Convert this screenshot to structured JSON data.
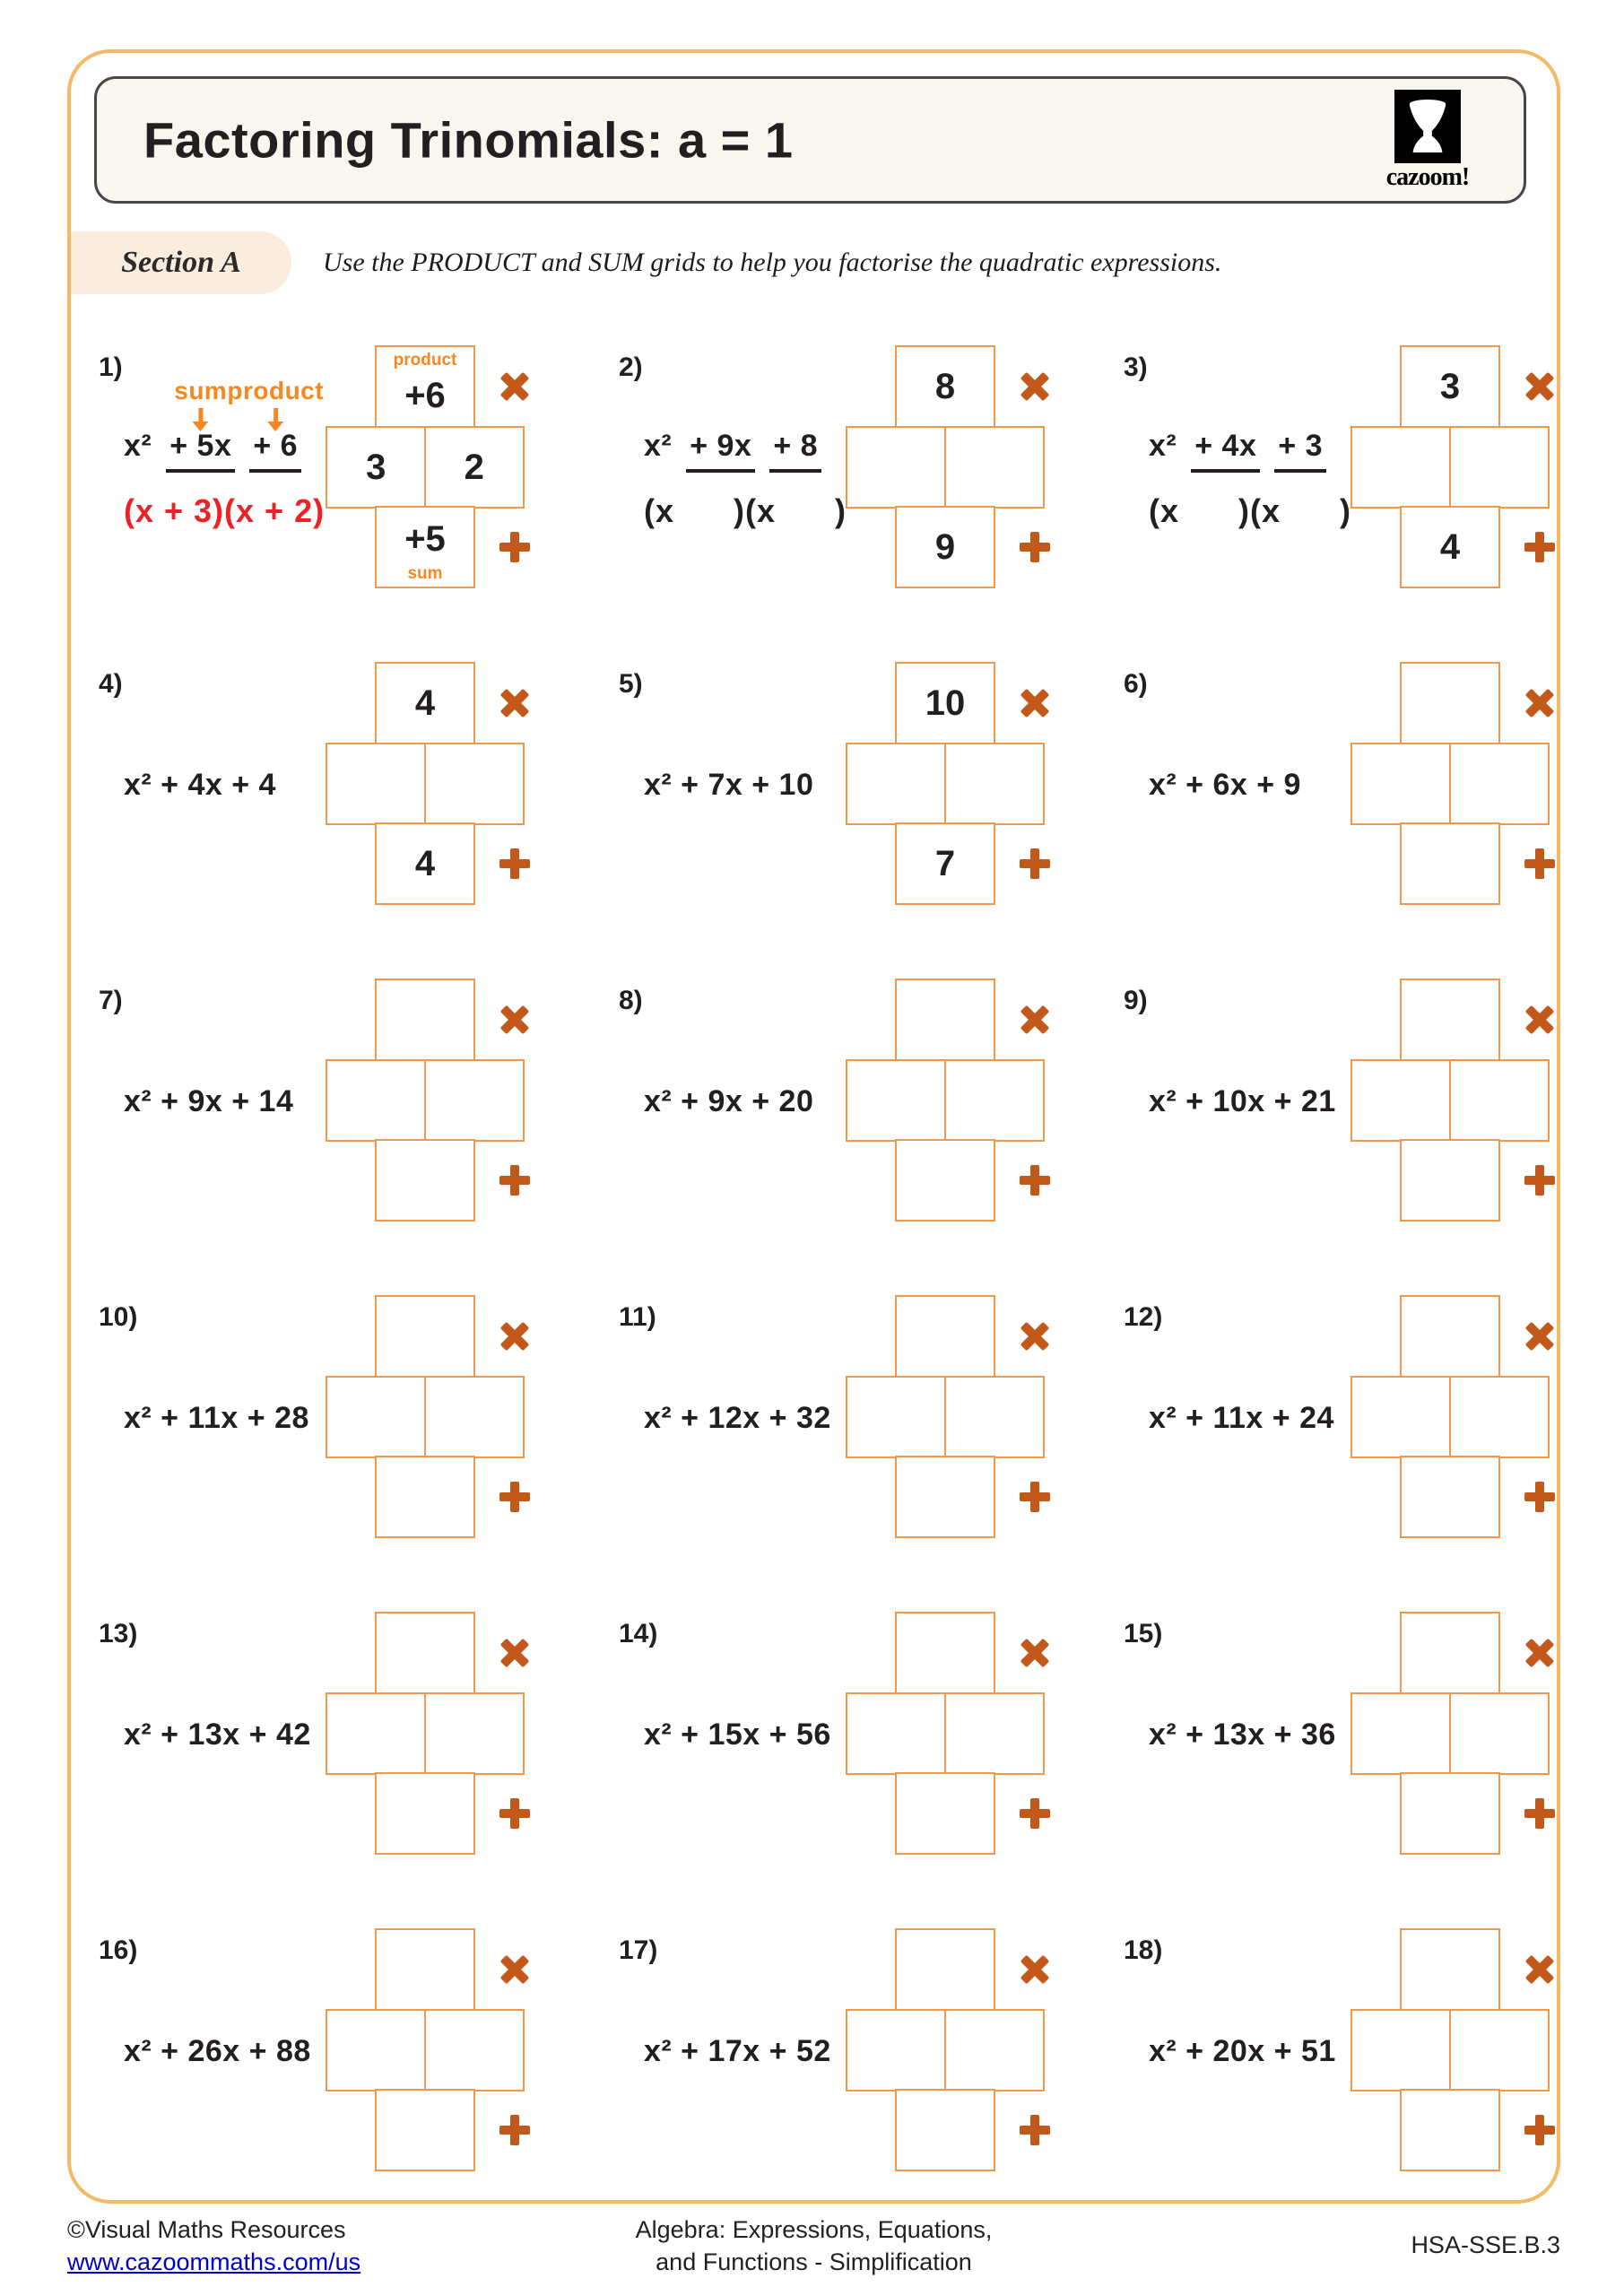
{
  "page": {
    "title": "Factoring Trinomials: a = 1",
    "logo_text": "cazoom!",
    "section_label": "Section A",
    "instruction": "Use the PRODUCT and SUM grids to help you factorise the quadratic expressions.",
    "colors": {
      "page_border": "#F4BA66",
      "grid_border": "#F0994A",
      "accent_orange": "#F6881F",
      "operator_orange": "#C2591B",
      "answer_red": "#EC2227",
      "ink": "#231F20",
      "header_bg": "#F8F6EF",
      "section_bg": "#FBEDDE",
      "link_blue": "#0000CC"
    }
  },
  "grid_labels": {
    "product": "product",
    "sum": "sum"
  },
  "problems": [
    {
      "number": "1)",
      "expr_parts": [
        "x²",
        "+ 5x",
        "+ 6"
      ],
      "annotations": [
        "sum",
        "product"
      ],
      "answer": "(x + 3)(x + 2)",
      "grid": {
        "product": "+6",
        "left": "3",
        "right": "2",
        "sum": "+5",
        "labels": true
      }
    },
    {
      "number": "2)",
      "expr_parts": [
        "x²",
        "+ 9x",
        "+ 8"
      ],
      "template": "(x      )(x      )",
      "grid": {
        "product": "8",
        "sum": "9"
      }
    },
    {
      "number": "3)",
      "expr_parts": [
        "x²",
        "+ 4x",
        "+ 3"
      ],
      "template": "(x      )(x      )",
      "grid": {
        "product": "3",
        "sum": "4"
      }
    },
    {
      "number": "4)",
      "expr": "x² + 4x + 4",
      "grid": {
        "product": "4",
        "sum": "4"
      }
    },
    {
      "number": "5)",
      "expr": "x² + 7x + 10",
      "grid": {
        "product": "10",
        "sum": "7"
      }
    },
    {
      "number": "6)",
      "expr": "x² + 6x + 9",
      "grid": {}
    },
    {
      "number": "7)",
      "expr": "x² + 9x + 14",
      "grid": {}
    },
    {
      "number": "8)",
      "expr": "x² + 9x + 20",
      "grid": {}
    },
    {
      "number": "9)",
      "expr": "x² + 10x + 21",
      "grid": {}
    },
    {
      "number": "10)",
      "expr": "x² + 11x + 28",
      "grid": {}
    },
    {
      "number": "11)",
      "expr": "x² + 12x + 32",
      "grid": {}
    },
    {
      "number": "12)",
      "expr": "x² + 11x + 24",
      "grid": {}
    },
    {
      "number": "13)",
      "expr": "x² + 13x + 42",
      "grid": {}
    },
    {
      "number": "14)",
      "expr": "x² + 15x + 56",
      "grid": {}
    },
    {
      "number": "15)",
      "expr": "x² + 13x + 36",
      "grid": {}
    },
    {
      "number": "16)",
      "expr": "x² + 26x + 88",
      "grid": {}
    },
    {
      "number": "17)",
      "expr": "x² + 17x + 52",
      "grid": {}
    },
    {
      "number": "18)",
      "expr": "x² + 20x + 51",
      "grid": {}
    }
  ],
  "footer": {
    "copyright": "©Visual Maths Resources",
    "url": "www.cazoommaths.com/us",
    "topic_line1": "Algebra: Expressions, Equations,",
    "topic_line2": "and Functions - Simplification",
    "standard_code": "HSA-SSE.B.3"
  }
}
